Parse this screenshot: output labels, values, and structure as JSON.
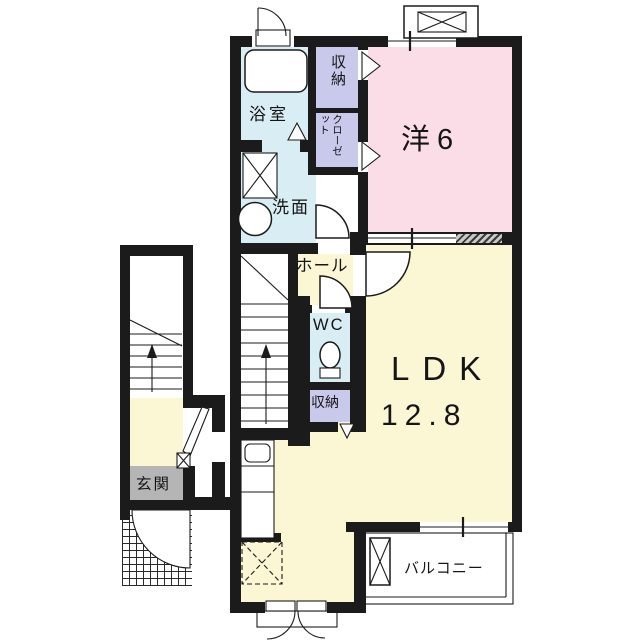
{
  "colors": {
    "wall": "#1b1b1b",
    "floor_yellow": "#fbf7d4",
    "room_pink": "#fbdde8",
    "water_blue": "#d8edf4",
    "storage_lavender": "#c9c9ec",
    "entrance_gray": "#b5b5b5"
  },
  "rooms": {
    "western_room": {
      "label": "洋6"
    },
    "ldk": {
      "name": "LDK",
      "size": "12.8"
    },
    "bath": {
      "label": "浴室"
    },
    "washroom": {
      "label": "洗面"
    },
    "hall": {
      "label": "ホール"
    },
    "wc": {
      "label": "WC"
    },
    "storage_top": {
      "label": "収納"
    },
    "closet": {
      "label": "クローゼット"
    },
    "storage_bottom": {
      "label": "収納"
    },
    "entrance": {
      "label": "玄関"
    },
    "balcony": {
      "label": "バルコニー"
    }
  }
}
